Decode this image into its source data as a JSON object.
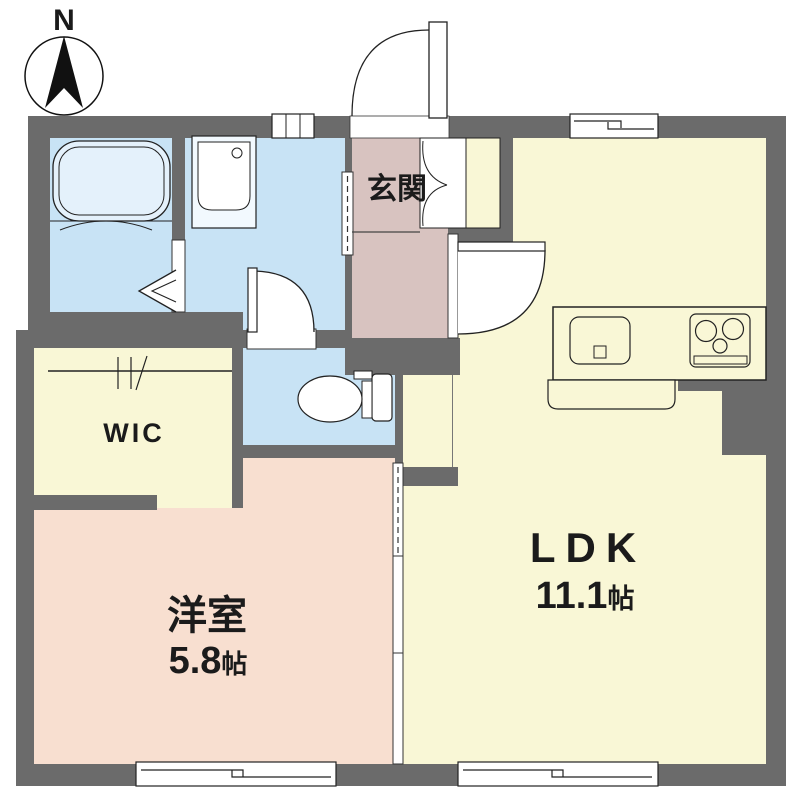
{
  "plan": {
    "compass_label": "N",
    "rooms": {
      "genkan": {
        "label": "玄関"
      },
      "ldk": {
        "label": "LDK",
        "area_value": "11.1",
        "area_unit": "帖"
      },
      "western_room": {
        "label": "洋室",
        "area_value": "5.8",
        "area_unit": "帖"
      },
      "wic": {
        "label": "WIC"
      }
    },
    "fixtures": [
      "bathtub",
      "washbasin",
      "toilet",
      "kitchen-sink",
      "stove",
      "kitchen-counter",
      "hanger-pipe",
      "shoe-closet"
    ],
    "colors": {
      "wall": "#6b6b6b",
      "wet_area": "#c8e3f5",
      "living_area": "#f9f7d6",
      "bedroom_area": "#f8dfd0",
      "entrance_area": "#d8c3c0",
      "fixture_fill": "#ffffff",
      "line": "#1a1a1a"
    }
  }
}
